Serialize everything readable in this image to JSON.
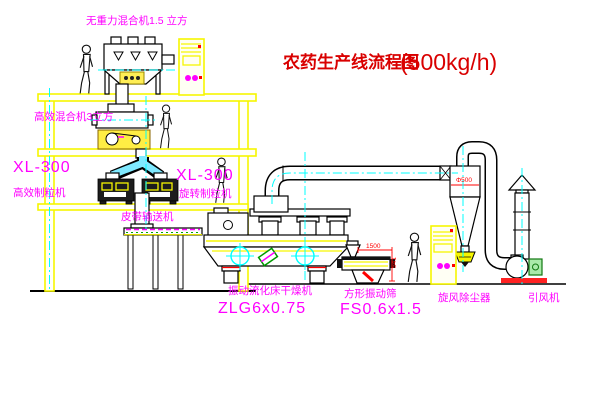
{
  "title": {
    "text": "农药生产线流程图",
    "capacity": "(500kg/h)"
  },
  "equipment_labels": {
    "gravity_mixer": "无重力混合机1.5 立方",
    "efficient_mixer": "高效混合机3立方",
    "granulator_left": {
      "model": "XL-300",
      "name": "高效制粒机"
    },
    "granulator_right": {
      "model": "XL-300",
      "name": "旋转制粒机"
    },
    "belt_conveyor": "皮带输送机",
    "fluid_bed_dryer": {
      "name": "振动流化床干燥机",
      "model": "ZLG6x0.75"
    },
    "square_sieve": {
      "name": "方形振动筛",
      "model": "FS0.6x1.5"
    },
    "cyclone": "旋风除尘器",
    "fan": "引风机"
  },
  "dimensions": {
    "sieve_width": "1500",
    "sieve_height": "541",
    "cyclone_diameter": "Φ500"
  },
  "colors": {
    "label_magenta": "#ff00ff",
    "title_red": "#d90000",
    "structure_yellow": "#f6f600",
    "centerline_cyan": "#00ffff",
    "dimension_red": "#ff0000",
    "background": "#ffffff"
  }
}
